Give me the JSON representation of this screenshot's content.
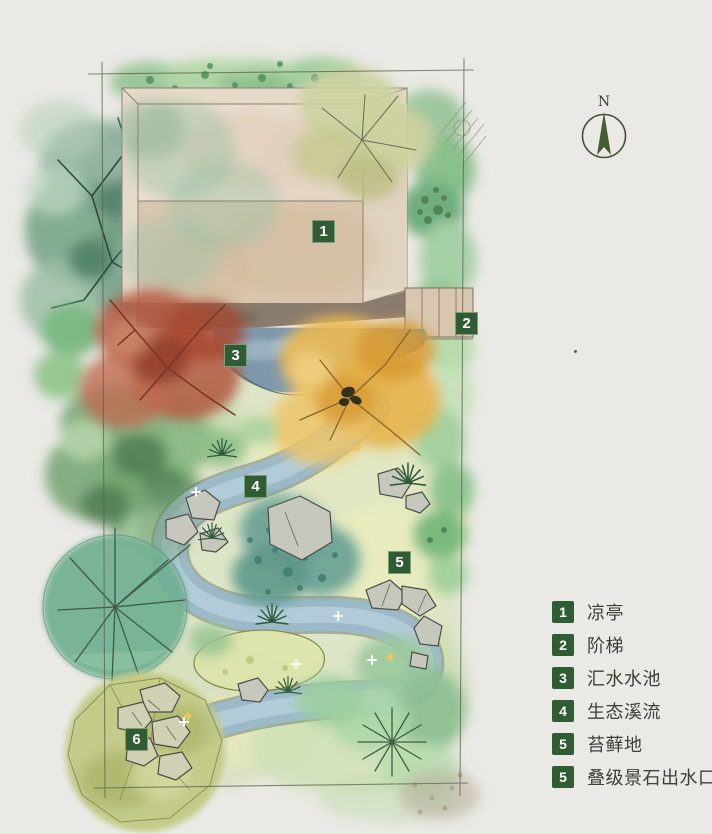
{
  "colors": {
    "background": "#eae9e5",
    "badge_green": "#2f5c33",
    "building_beige": "#ddcbb3",
    "water_blue": "#8fb0c2",
    "canopy_green": "#8fb996",
    "red_tree": "#b25944",
    "golden_tree": "#e7b44a"
  },
  "compass": {
    "label": "N"
  },
  "plan_markers": [
    "1",
    "2",
    "3",
    "4",
    "5",
    "6"
  ],
  "legend": {
    "items": [
      {
        "num": "1",
        "label": "凉亭"
      },
      {
        "num": "2",
        "label": "阶梯"
      },
      {
        "num": "3",
        "label": "汇水水池"
      },
      {
        "num": "4",
        "label": "生态溪流"
      },
      {
        "num": "5",
        "label": "苔藓地"
      },
      {
        "num": "5",
        "label": "叠级景石出水口"
      }
    ]
  }
}
